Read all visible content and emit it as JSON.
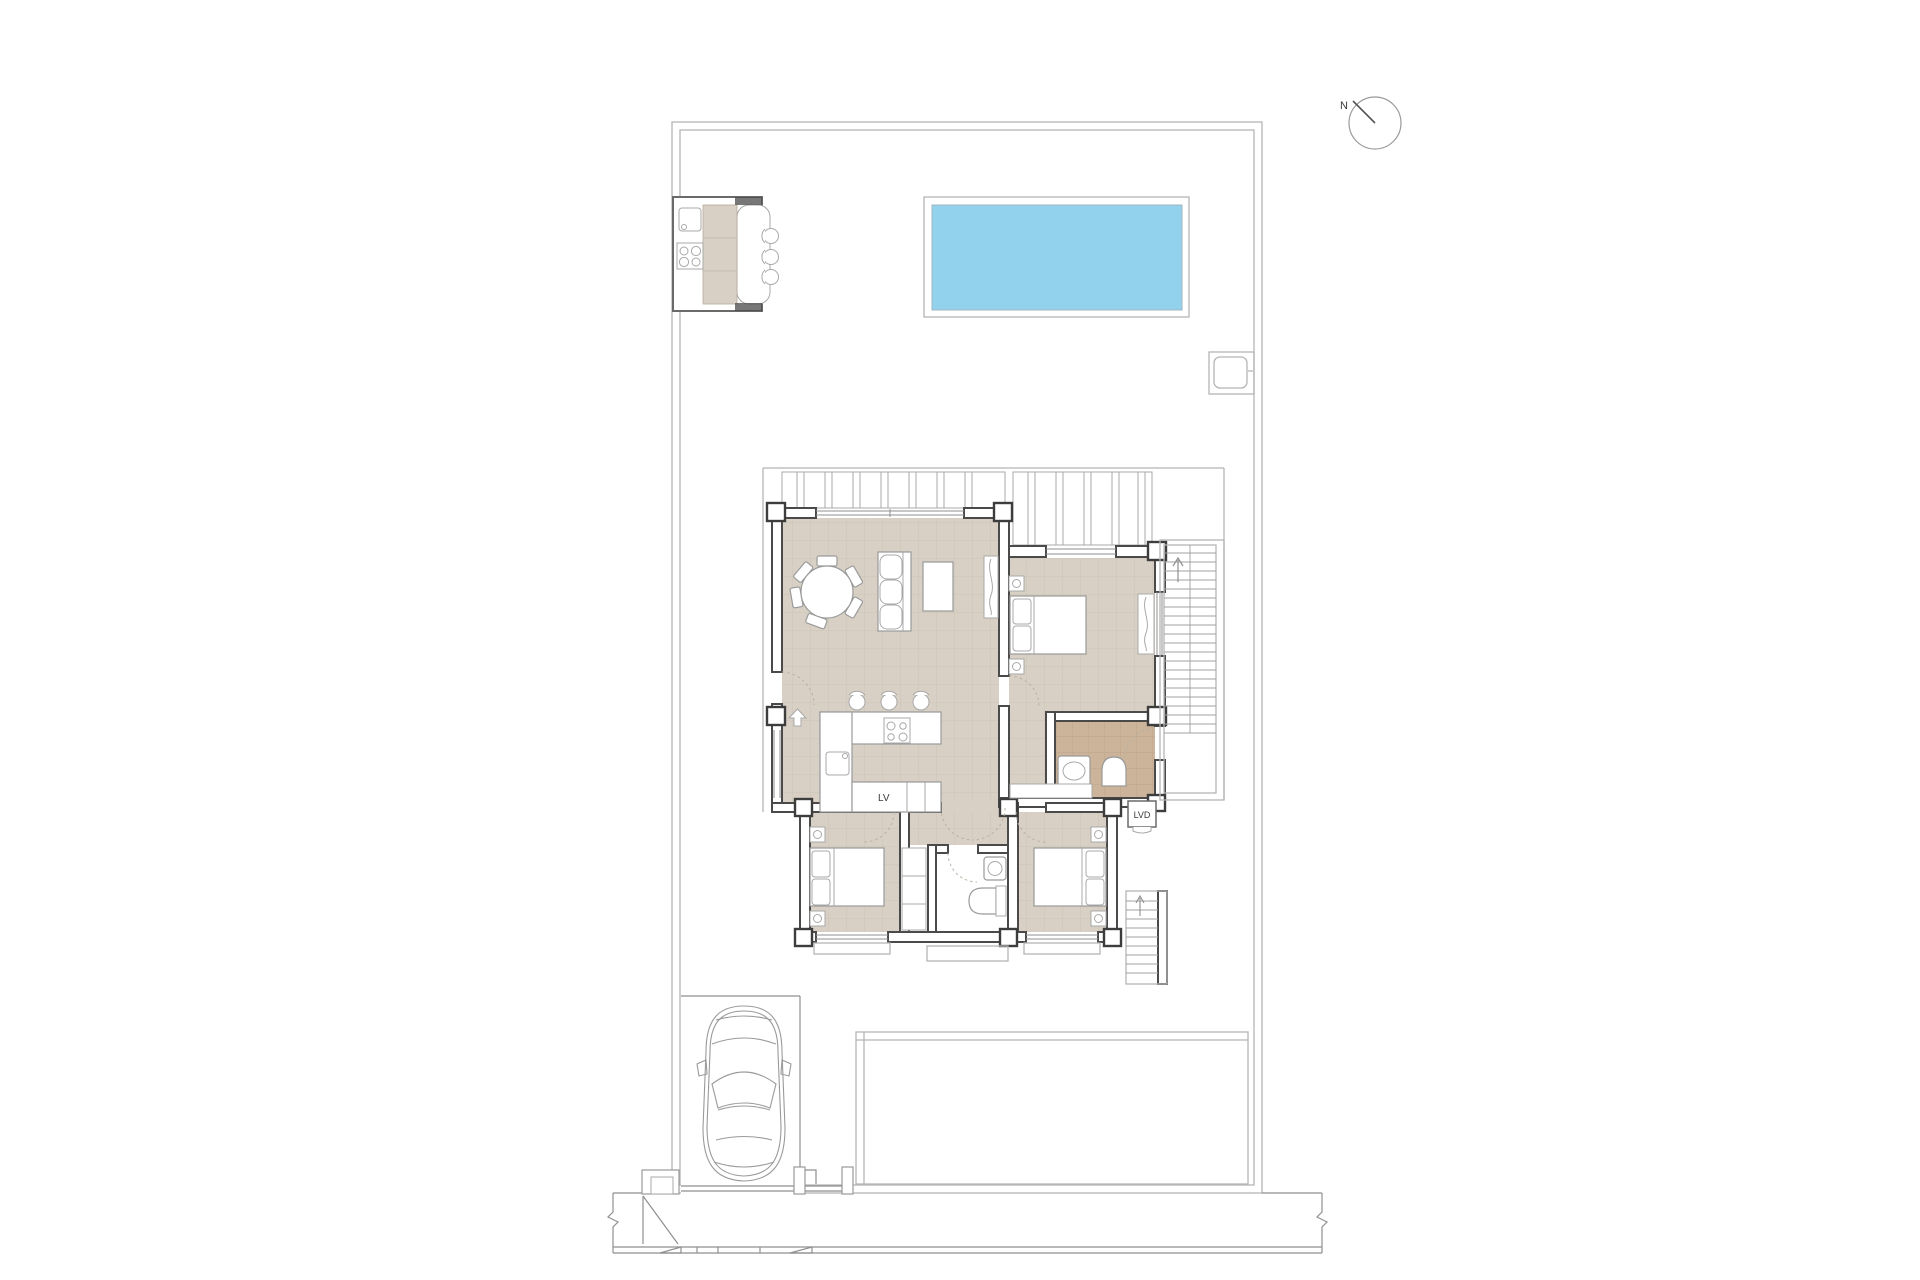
{
  "plan": {
    "title": "villa-site-floor-plan",
    "labels": {
      "north": "N",
      "dishwasher": "LV",
      "washer": "LVD"
    },
    "colors": {
      "pool_water": "#92d2ed",
      "pool_border": "#a0b7c2",
      "floor_main": "#d8d0c4",
      "floor_grid": "#c8bfb0",
      "floor_bath": "#cbb49a",
      "floor_bath_grid": "#b89f84",
      "wall": "#4a4a4a",
      "line_light": "#b5b5b5",
      "line_mid": "#8f8f8f"
    },
    "features": [
      "plot-boundary",
      "swimming-pool",
      "outdoor-kitchen",
      "bar-stools",
      "north-compass",
      "living-dining-room",
      "kitchen",
      "bedroom-1",
      "bedroom-2",
      "bedroom-3",
      "bathroom-1",
      "bathroom-2",
      "stairs-upper",
      "stairs-lower",
      "pergola",
      "patio-slab",
      "car",
      "driveway-gate",
      "street-sidewalk"
    ]
  }
}
